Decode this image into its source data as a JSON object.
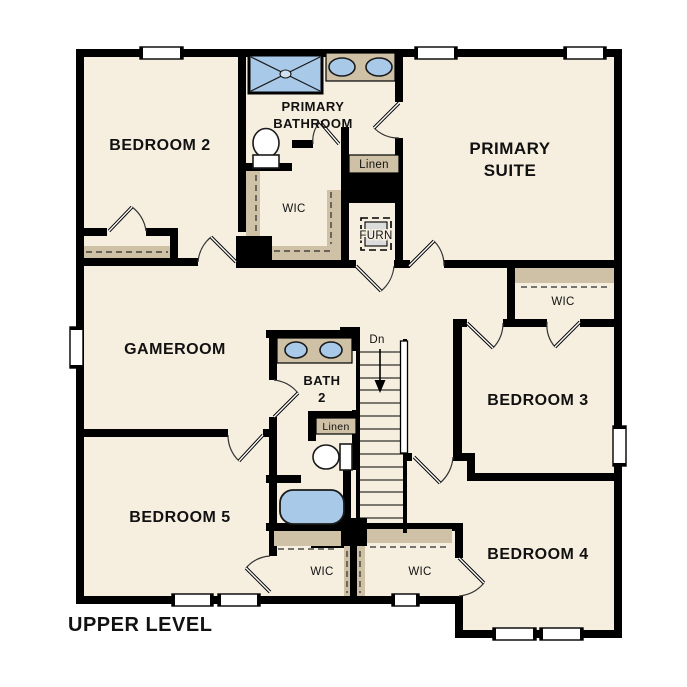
{
  "title": {
    "text": "UPPER LEVEL"
  },
  "rooms": {
    "bedroom2": "BEDROOM 2",
    "primary_bathroom_line1": "PRIMARY",
    "primary_bathroom_line2": "BATHROOM",
    "primary_suite_line1": "PRIMARY",
    "primary_suite_line2": "SUITE",
    "gameroom": "GAMEROOM",
    "bath2_line1": "BATH",
    "bath2_line2": "2",
    "bedroom3": "BEDROOM 3",
    "bedroom4": "BEDROOM 4",
    "bedroom5": "BEDROOM 5"
  },
  "labels": {
    "wic": "WIC",
    "linen": "Linen",
    "furnace": "FURN",
    "stairs_down": "Dn"
  },
  "colors": {
    "wall": "#000000",
    "floor": "#f6efe0",
    "shelf": "#cfc1a5",
    "fixture_blue": "#a9c9e9",
    "furnace_gray": "#dcdcdc",
    "background": "#ffffff",
    "text": "#111111"
  }
}
